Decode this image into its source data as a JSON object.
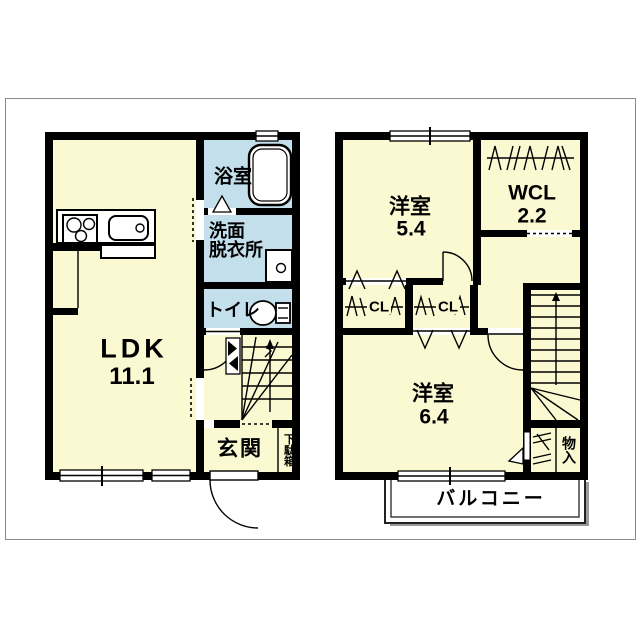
{
  "floorplan": {
    "floor1": {
      "ldk": {
        "name": "LDK",
        "area": "11.1"
      },
      "bathroom": "浴室",
      "washroom": {
        "line1": "洗面",
        "line2": "脱衣所"
      },
      "toilet": "トイレ",
      "entrance": "玄関",
      "shoe_cabinet": "下駄箱"
    },
    "floor2": {
      "bedroom1": {
        "name": "洋室",
        "area": "5.4"
      },
      "wcl": {
        "name": "WCL",
        "area": "2.2"
      },
      "closet1": "CL",
      "closet2": "CL",
      "bedroom2": {
        "name": "洋室",
        "area": "6.4"
      },
      "storage": "物入",
      "balcony": "バルコニー"
    },
    "colors": {
      "room_fill": "#FBF9D2",
      "wet_area_fill": "#C2DFEB",
      "wall": "#000000",
      "background": "#FFFFFF"
    }
  }
}
